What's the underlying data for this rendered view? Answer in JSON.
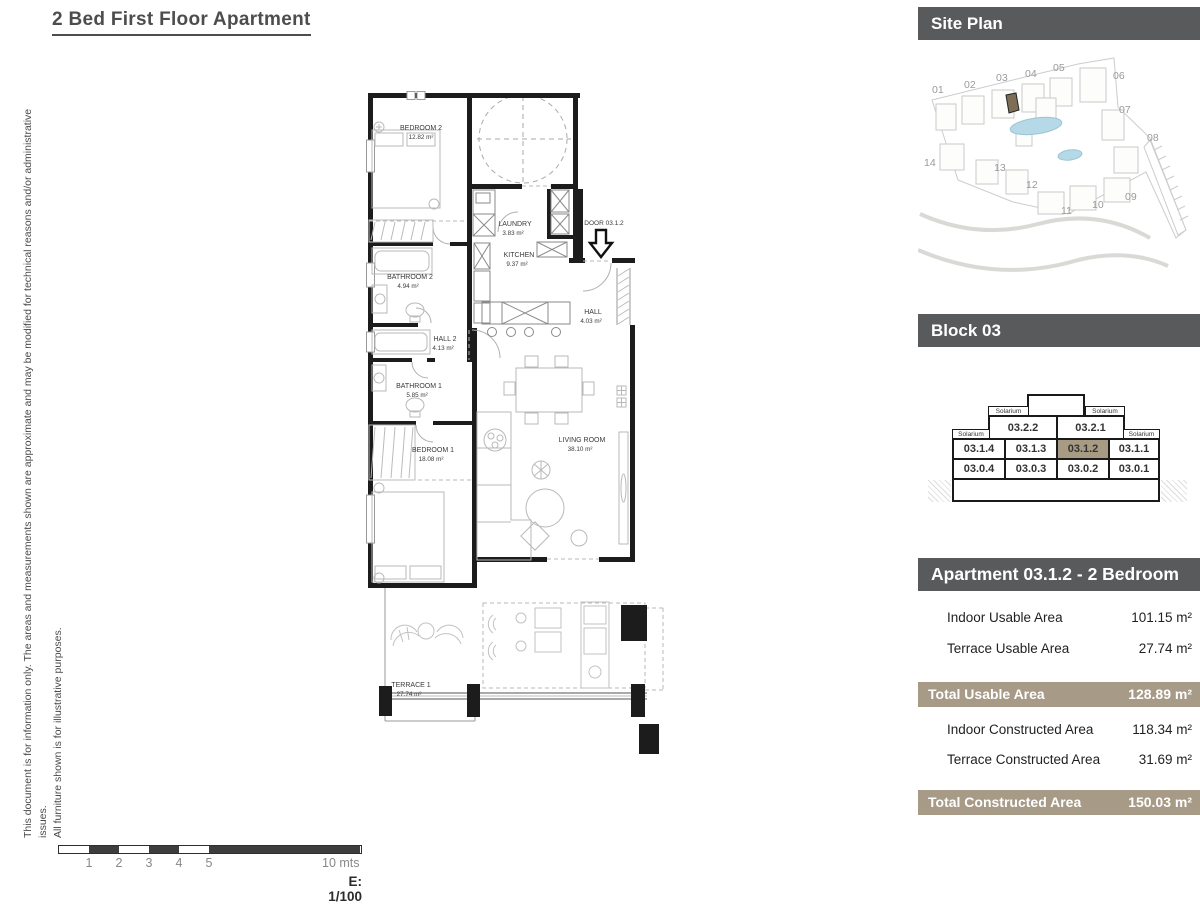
{
  "title": "2 Bed First Floor Apartment",
  "disclaimer": {
    "line1": "This document is for information only. The areas and measurements shown are approximate and may be modified for technical reasons and/or administrative issues.",
    "line2": "All furniture shown is for illustrative purposes."
  },
  "floor_plan": {
    "door_label": "DOOR 03.1.2",
    "rooms": [
      {
        "name": "BEDROOM 2",
        "area": "12.82 m²"
      },
      {
        "name": "LAUNDRY",
        "area": "3.83 m²"
      },
      {
        "name": "KITCHEN",
        "area": "9.37 m²"
      },
      {
        "name": "BATHROOM 2",
        "area": "4.94 m²"
      },
      {
        "name": "HALL",
        "area": "4.03 m²"
      },
      {
        "name": "HALL 2",
        "area": "4.13 m²"
      },
      {
        "name": "BATHROOM 1",
        "area": "5.85 m²"
      },
      {
        "name": "BEDROOM 1",
        "area": "18.08 m²"
      },
      {
        "name": "LIVING ROOM",
        "area": "38.10 m²"
      },
      {
        "name": "TERRACE 1",
        "area": "27.74 m²"
      }
    ]
  },
  "scale_bar": {
    "ticks": [
      "1",
      "2",
      "3",
      "4",
      "5"
    ],
    "end_label": "10 mts",
    "scale_text": "E: 1/100"
  },
  "site_plan": {
    "header": "Site Plan",
    "blocks": [
      "01",
      "02",
      "03",
      "04",
      "05",
      "06",
      "07",
      "08",
      "09",
      "10",
      "11",
      "12",
      "13",
      "14"
    ]
  },
  "block03": {
    "header": "Block 03",
    "solarium_label": "Solarium",
    "units": [
      "03.2.2",
      "03.2.1",
      "03.1.4",
      "03.1.3",
      "03.1.2",
      "03.1.1",
      "03.0.4",
      "03.0.3",
      "03.0.2",
      "03.0.1"
    ],
    "highlighted_unit": "03.1.2"
  },
  "apartment": {
    "header": "Apartment 03.1.2 - 2 Bedroom",
    "rows_usable": [
      {
        "label": "Indoor Usable Area",
        "value": "101.15 m²"
      },
      {
        "label": "Terrace Usable Area",
        "value": "27.74 m²"
      }
    ],
    "total_usable": {
      "label": "Total Usable Area",
      "value": "128.89 m²"
    },
    "rows_constructed": [
      {
        "label": "Indoor Constructed Area",
        "value": "118.34 m²"
      },
      {
        "label": "Terrace Constructed Area",
        "value": "31.69 m²"
      }
    ],
    "total_constructed": {
      "label": "Total Constructed Area",
      "value": "150.03 m²"
    }
  },
  "colors": {
    "header_gray": "#595a5c",
    "total_tan": "#a79a86",
    "highlight_tan": "#a89b84",
    "pool_blue": "#b5d9e6"
  }
}
